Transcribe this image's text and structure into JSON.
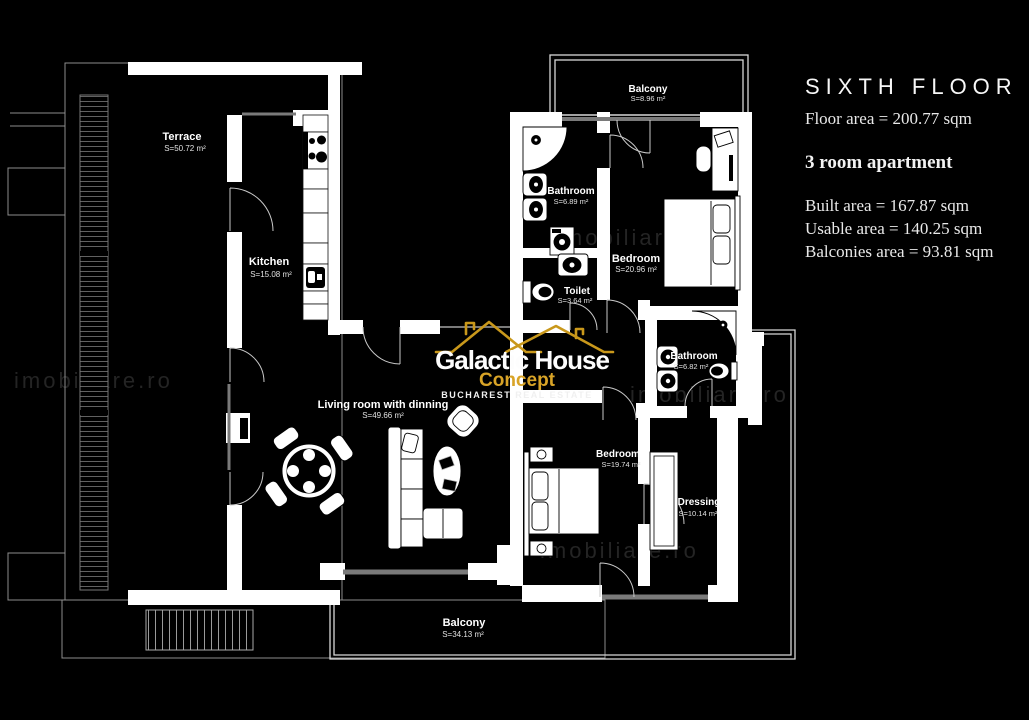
{
  "panel": {
    "floor_title": "SIXTH FLOOR",
    "floor_area": "Floor area = 200.77 sqm",
    "apartment_type": "3 room apartment",
    "built_area": "Built area = 167.87 sqm",
    "usable_area": "Usable area = 140.25 sqm",
    "balconies_area": "Balconies area = 93.81 sqm"
  },
  "logo": {
    "name": "Galactic House",
    "concept": "Concept",
    "tagline": "BUCHAREST REAL ESTATE",
    "gold": "#C9981B",
    "white": "#FFFFFF"
  },
  "watermark": "imobiliare.ro",
  "rooms": [
    {
      "id": "terrace",
      "name": "Terrace",
      "area": "S=50.72 m²"
    },
    {
      "id": "kitchen",
      "name": "Kitchen",
      "area": "S=15.08 m²"
    },
    {
      "id": "balcony-top",
      "name": "Balcony",
      "area": "S=8.96 m²"
    },
    {
      "id": "bathroom-1",
      "name": "Bathroom",
      "area": "S=6.89 m²"
    },
    {
      "id": "toilet",
      "name": "Toilet",
      "area": "S=3.64 m²"
    },
    {
      "id": "bedroom-1",
      "name": "Bedroom",
      "area": "S=20.96 m²"
    },
    {
      "id": "bathroom-2",
      "name": "Bathroom",
      "area": "S=6.82 m²"
    },
    {
      "id": "living",
      "name": "Living room with dinning",
      "area": "S=49.66 m²"
    },
    {
      "id": "bedroom-2",
      "name": "Bedroom",
      "area": "S=19.74 m²"
    },
    {
      "id": "dressing",
      "name": "Dressing",
      "area": "S=10.14 m²"
    },
    {
      "id": "balcony-bottom",
      "name": "Balcony",
      "area": "S=34.13 m²"
    }
  ]
}
